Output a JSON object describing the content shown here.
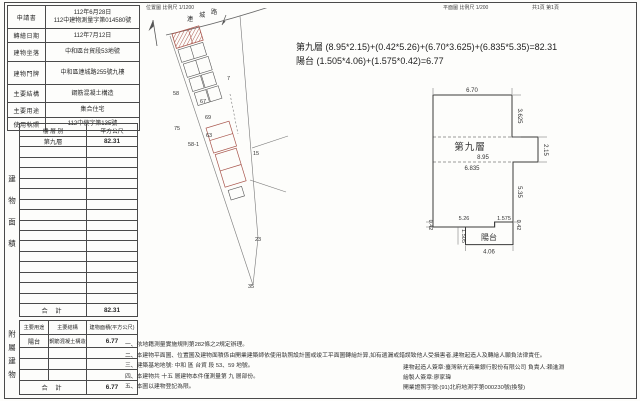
{
  "page": {
    "background_color": "#fdfdfb",
    "line_color": "#4a4a4a",
    "subject_building_red": "#a8554c"
  },
  "header": {
    "location_map_label": "位置圖 比例尺 1/1200",
    "floor_plan_scale_label": "平面圖 比例尺 1/200",
    "page_label": "共1頁 第1頁"
  },
  "info_table": {
    "rows": [
      {
        "label": "申請書",
        "value_line1": "112年6月28日",
        "value_line2": "112中建物測量字第014580號"
      },
      {
        "label": "轉繪日期",
        "value": "112年7月12日"
      },
      {
        "label": "建物坐落",
        "value": "中和區台貿段53地號"
      },
      {
        "label": "建物門牌",
        "value": "中和區連城路255號九樓"
      },
      {
        "label": "主要結構",
        "value": "鋼筋混凝土構造"
      },
      {
        "label": "主要用途",
        "value": "集合住宅"
      },
      {
        "label": "使用執照",
        "value": "112中使字第135號"
      }
    ]
  },
  "floor_area_section": {
    "side_label": "建物面積",
    "col1_header": "樓 層 別",
    "col2_header": "平方公尺",
    "floor_name": "第九層",
    "floor_area": "82.31",
    "total_label": "合  計",
    "total_value": "82.31"
  },
  "attached_section": {
    "side_label": "附屬建物",
    "col1_header": "主要用途",
    "col2_header": "主要結構",
    "col3_header": "建物面積(平方公尺)",
    "use": "陽台",
    "structure": "鋼筋混凝土構造",
    "area": "6.77",
    "total_label": "合  計",
    "total_value": "6.77"
  },
  "formula": {
    "line1": "第九層 (8.95*2.15)+(0.42*5.26)+(6.70*3.625)+(6.835*5.35)=82.31",
    "line2": "陽台 (1.505*4.06)+(1.575*0.42)=6.77"
  },
  "site_map": {
    "road_chars": [
      "連",
      "城",
      "路"
    ],
    "lot_numbers": [
      "58",
      "67",
      "69",
      "75",
      "58-1",
      "63",
      "7",
      "15",
      "23",
      "35"
    ]
  },
  "floor_plan": {
    "room_label": "第九層",
    "balcony_label": "陽台",
    "dim_top": "6.70",
    "dim_right_upper": "3.625",
    "dim_band_height": "2.15",
    "dim_band_width": "8.95",
    "dim_mid_width": "6.835",
    "dim_right_lower": "5.35",
    "dim_bottom_left_w": "5.26",
    "dim_bottom_right_w": "1.575",
    "dim_step_left_h": "0.42",
    "dim_step_right_h": "0.42",
    "dim_balcony_h": "1.505",
    "dim_balcony_w": "4.06"
  },
  "notes": {
    "items": [
      "一、依地籍測量實施規則第282條之2規定辦理。",
      "二、本建物平面圖、位置圖及建物面積係由開業建築師依使用執照設計圖或竣工平面圖轉繪計算,如有遺漏或錯誤致他人受損害者,建物起造人及轉繪人願負法律責任。",
      "三、建築基地地號: 中和 區 台貿 段 53、59 地號。",
      "四、本建物共 十五 層建物本件僅測量第 九 層部份。",
      "五、本圖以建物登記為限。"
    ],
    "signature_lines": [
      "建物起造人簽章:臺灣新光商業銀行股份有限公司 負責人:賴進淵",
      "繪製人簽章:廖家瑋",
      "開業證照字號:(91)北府地測字第000230號(換發)"
    ]
  }
}
